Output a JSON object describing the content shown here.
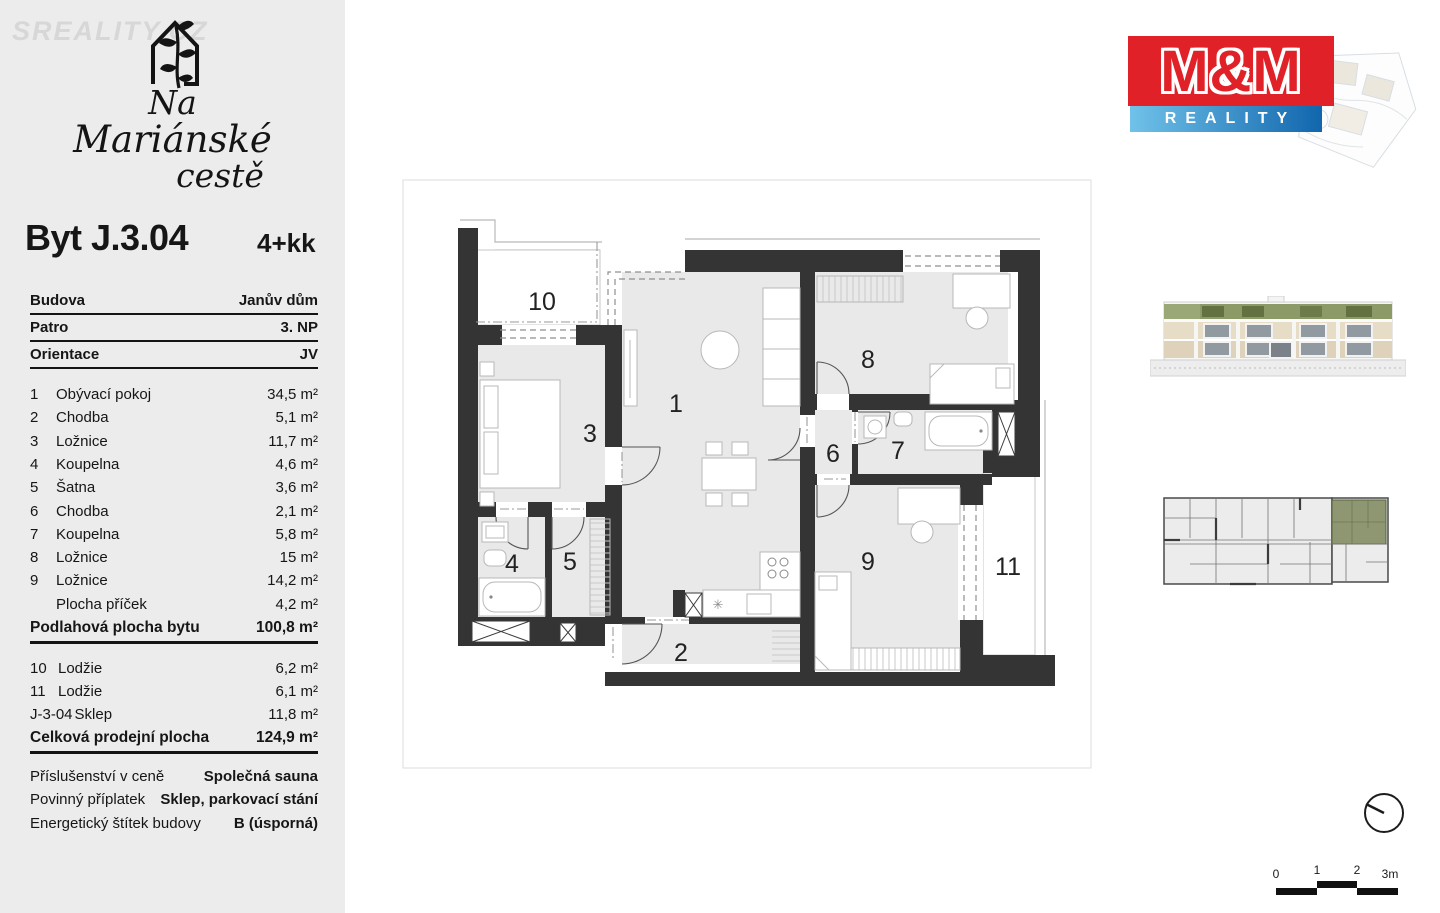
{
  "watermark": "SREALITY.CZ",
  "brand": {
    "line1": "Na",
    "line2": "Mariánské",
    "line3": "cestě"
  },
  "unit": {
    "title": "Byt J.3.04",
    "layout": "4+kk"
  },
  "info": [
    {
      "label": "Budova",
      "value": "Janův dům"
    },
    {
      "label": "Patro",
      "value": "3. NP"
    },
    {
      "label": "Orientace",
      "value": "JV"
    }
  ],
  "rooms": [
    {
      "num": "1",
      "name": "Obývací pokoj",
      "area": "34,5 m²"
    },
    {
      "num": "2",
      "name": "Chodba",
      "area": "5,1 m²"
    },
    {
      "num": "3",
      "name": "Ložnice",
      "area": "11,7 m²"
    },
    {
      "num": "4",
      "name": "Koupelna",
      "area": "4,6 m²"
    },
    {
      "num": "5",
      "name": "Šatna",
      "area": "3,6 m²"
    },
    {
      "num": "6",
      "name": "Chodba",
      "area": "2,1 m²"
    },
    {
      "num": "7",
      "name": "Koupelna",
      "area": "5,8 m²"
    },
    {
      "num": "8",
      "name": "Ložnice",
      "area": "15 m²"
    },
    {
      "num": "9",
      "name": "Ložnice",
      "area": "14,2 m²"
    },
    {
      "num": "",
      "name": "Plocha příček",
      "area": "4,2 m²"
    }
  ],
  "totals": {
    "floor_label": "Podlahová plocha bytu",
    "floor_value": "100,8 m²",
    "total_label": "Celková prodejní plocha",
    "total_value": "124,9 m²"
  },
  "extras": [
    {
      "num": "10",
      "name": "Lodžie",
      "area": "6,2 m²"
    },
    {
      "num": "11",
      "name": "Lodžie",
      "area": "6,1 m²"
    },
    {
      "num": "J-3-04",
      "name": "Sklep",
      "area": "11,8 m²"
    }
  ],
  "details": [
    {
      "label": "Příslušenství v ceně",
      "value": "Společná sauna"
    },
    {
      "label": "Povinný příplatek",
      "value": "Sklep, parkovací stání"
    },
    {
      "label": "Energetický štítek budovy",
      "value": "B (úsporná)"
    }
  ],
  "agency": {
    "name": "M&M",
    "tagline": "REALITY",
    "red": "#e02128",
    "blue_from": "#70c2e9",
    "blue_to": "#1166ad"
  },
  "plan": {
    "labels": {
      "r1": "1",
      "r2": "2",
      "r3": "3",
      "r4": "4",
      "r5": "5",
      "r6": "6",
      "r7": "7",
      "r8": "8",
      "r9": "9",
      "r10": "10",
      "r11": "11"
    },
    "symbols": {
      "stove": "✳"
    },
    "colors": {
      "wall": "#343434",
      "room_fill": "#e9e9e9",
      "highlight_green": "#8e9772"
    }
  },
  "scalebar": {
    "labels": [
      "0",
      "1",
      "2",
      "3m"
    ]
  }
}
